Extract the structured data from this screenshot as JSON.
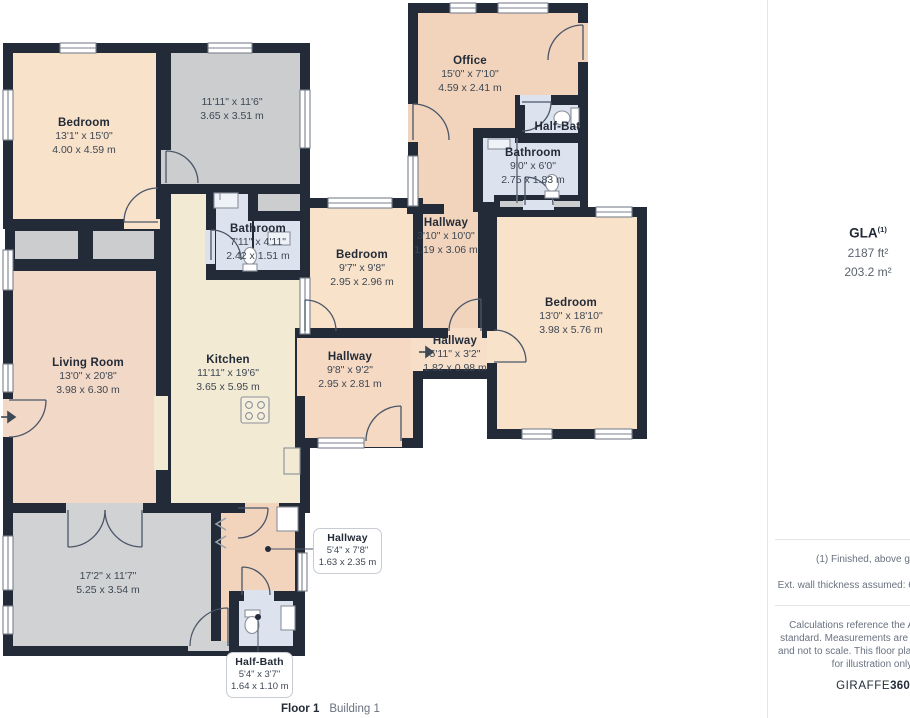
{
  "rooms": [
    {
      "name": "Bedroom",
      "ft": "13'1\" x 15'0\"",
      "m": "4.00 x 4.59 m"
    },
    {
      "name": "",
      "ft": "11'11\" x 11'6\"",
      "m": "3.65 x 3.51 m"
    },
    {
      "name": "Bathroom",
      "ft": "7'11\" x 4'11\"",
      "m": "2.42 x 1.51 m"
    },
    {
      "name": "Bedroom",
      "ft": "9'7\" x 9'8\"",
      "m": "2.95 x 2.96 m"
    },
    {
      "name": "Office",
      "ft": "15'0\" x 7'10\"",
      "m": "4.59 x 2.41 m"
    },
    {
      "name": "Half-Bath"
    },
    {
      "name": "Bathroom",
      "ft": "9'0\" x 6'0\"",
      "m": "2.75 x 1.83 m"
    },
    {
      "name": "Hallway",
      "ft": "3'10\" x 10'0\"",
      "m": "1.19 x 3.06 m"
    },
    {
      "name": "Bedroom",
      "ft": "13'0\" x 18'10\"",
      "m": "3.98 x 5.76 m"
    },
    {
      "name": "Hallway",
      "ft": "5'11\" x 3'2\"",
      "m": "1.82 x 0.98 m"
    },
    {
      "name": "Hallway",
      "ft": "9'8\" x 9'2\"",
      "m": "2.95 x 2.81 m"
    },
    {
      "name": "Living Room",
      "ft": "13'0\" x 20'8\"",
      "m": "3.98 x 6.30 m"
    },
    {
      "name": "Kitchen",
      "ft": "11'11\" x 19'6\"",
      "m": "3.65 x 5.95 m"
    },
    {
      "name": "",
      "ft": "17'2\" x 11'7\"",
      "m": "5.25 x 3.54 m"
    }
  ],
  "callouts": [
    {
      "name": "Hallway",
      "ft": "5'4\" x 7'8\"",
      "m": "1.63 x 2.35 m"
    },
    {
      "name": "Half-Bath",
      "ft": "5'4\" x 3'7\"",
      "m": "1.64 x 1.10 m"
    }
  ],
  "floor": {
    "label": "Floor 1",
    "building": "Building 1"
  },
  "sidebar": {
    "gla_label": "GLA",
    "gla_sup": "(1)",
    "gla_ft": "2187 ft²",
    "gla_m": "203.2 m²",
    "note_finished": "(1) Finished, above grade",
    "note_wall": "Ext. wall thickness assumed: 6 in/15.24 cm",
    "disclaimer": "Calculations reference the ANSI-Z765 standard. Measurements are approximate and not to scale. This floor plan is intended for illustration only.",
    "brand_giraffe": "GIRAFFE",
    "brand_360": "360"
  },
  "icons": {
    "entry_arrow_icon": "→"
  },
  "colors": {
    "wall": "#232B38",
    "bedroom": "#F8E2CA",
    "office_hall": "#F2D4BC",
    "living": "#F2D8C6",
    "kitchen": "#F2EAD3",
    "hall_mid": "#F5D9C3",
    "bathroom": "#DDE3EE",
    "gray_room": "#CBCDCF",
    "gray_room_dark": "#D1D2D4"
  }
}
